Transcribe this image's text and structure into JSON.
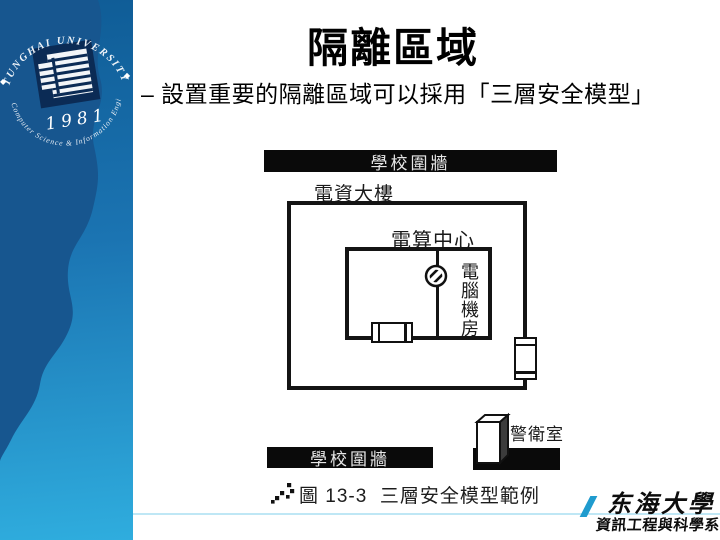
{
  "slide": {
    "title": "隔離區域",
    "bullet": "– 設置重要的隔離區域可以採用「三層安全模型」"
  },
  "seal": {
    "arc_top": "TUNGHAI UNIVERSITY",
    "arc_bottom": "Computer Science & Information Engineering",
    "year": "1981",
    "diamond": "◆"
  },
  "figure": {
    "outer_wall_top": "學校圍牆",
    "building_label": "電資大樓",
    "center_label": "電算中心",
    "room_label": "電腦機房",
    "outer_wall_bottom": "學校圍牆",
    "guard_label": "警衛室",
    "caption": "圖 13-3  三層安全模型範例"
  },
  "footer": {
    "university": "东海大學",
    "department": "資訊工程與科學系"
  },
  "colors": {
    "sidebar_top": "#0f5c96",
    "sidebar_bottom": "#2fadde",
    "sidebar_wave": "#17568f",
    "wall_bar": "#0a0a0a",
    "accent_slash": "#1f9bce",
    "footer_divider": "#bfe7f5"
  }
}
